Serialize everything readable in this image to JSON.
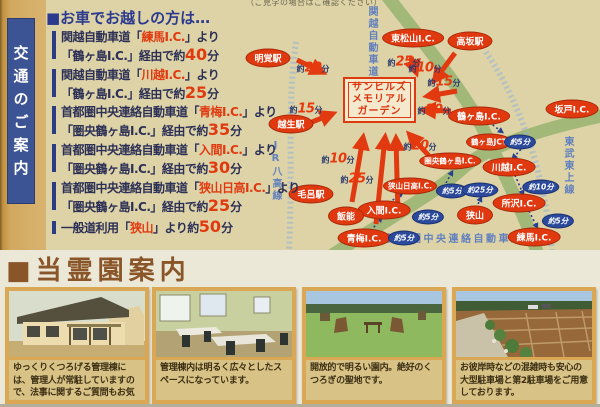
{
  "note": {
    "text": "（ご見学の場合はご確認ください）"
  },
  "sidebar": {
    "label": "交通のご案内"
  },
  "directions": {
    "title": "■お車でお越しの方は…",
    "entries": [
      {
        "pre1": "関越自動車道「",
        "ic": "練馬I.C.",
        "post1": "」より",
        "pre2": "「鶴ヶ島I.C.」経由で約",
        "min": "40",
        "suf": "分"
      },
      {
        "pre1": "関越自動車道「",
        "ic": "川越I.C.",
        "post1": "」より",
        "pre2": "「鶴ヶ島I.C.」経由で約",
        "min": "25",
        "suf": "分"
      },
      {
        "pre1": "首都圏中央連絡自動車道「",
        "ic": "青梅I.C.",
        "post1": "」より",
        "pre2": "「圏央鶴ヶ島I.C.」経由で約",
        "min": "35",
        "suf": "分"
      },
      {
        "pre1": "首都圏中央連絡自動車道「",
        "ic": "入間I.C.",
        "post1": "」より",
        "pre2": "「圏央鶴ヶ島I.C.」経由で約",
        "min": "30",
        "suf": "分"
      },
      {
        "pre1": "首都圏中央連絡自動車道「",
        "ic": "狭山日高I.C.",
        "post1": "」より",
        "pre2": "「圏央鶴ヶ島I.C.」経由で約",
        "min": "25",
        "suf": "分"
      },
      {
        "pre1": "一般道利用「",
        "ic": "狭山",
        "post1": "」より約",
        "min": "50",
        "suf": "分"
      }
    ]
  },
  "map": {
    "facility": {
      "line1": "サンヒルズ",
      "line2": "メモリアル",
      "line3": "ガーデン"
    },
    "road_labels": {
      "kanetsu": "関越自動車道",
      "jr_hachiko": "JR八高線",
      "tobu_tojo": "東武東上線",
      "keno": "首都圏中央連絡自動車道"
    },
    "time_prefix": "約",
    "time_suffix": "分",
    "nodes": [
      {
        "label": "明覚駅",
        "x": 268,
        "y": 58,
        "type": "red"
      },
      {
        "label": "東松山I.C.",
        "x": 413,
        "y": 38,
        "type": "red"
      },
      {
        "label": "高坂駅",
        "x": 470,
        "y": 41,
        "type": "red"
      },
      {
        "label": "越生駅",
        "x": 291,
        "y": 124,
        "type": "red"
      },
      {
        "label": "坂戸I.C.",
        "x": 572,
        "y": 109,
        "type": "red"
      },
      {
        "label": "鶴ヶ島I.C.",
        "x": 479,
        "y": 116,
        "type": "red"
      },
      {
        "label": "鶴ヶ島JCT",
        "x": 489,
        "y": 142,
        "type": "red",
        "small": true
      },
      {
        "label": "圏央鶴ヶ島I.C.",
        "x": 450,
        "y": 161,
        "type": "red",
        "small": true
      },
      {
        "label": "川越I.C.",
        "x": 509,
        "y": 167,
        "type": "red"
      },
      {
        "label": "狭山日高I.C.",
        "x": 410,
        "y": 186,
        "type": "red",
        "small": true
      },
      {
        "label": "毛呂駅",
        "x": 311,
        "y": 194,
        "type": "red"
      },
      {
        "label": "所沢I.C.",
        "x": 519,
        "y": 203,
        "type": "red"
      },
      {
        "label": "入間I.C.",
        "x": 384,
        "y": 210,
        "type": "red"
      },
      {
        "label": "飯能",
        "x": 346,
        "y": 216,
        "type": "red"
      },
      {
        "label": "狭山",
        "x": 475,
        "y": 215,
        "type": "red"
      },
      {
        "label": "青梅I.C.",
        "x": 364,
        "y": 238,
        "type": "red"
      },
      {
        "label": "練馬I.C.",
        "x": 534,
        "y": 237,
        "type": "red"
      },
      {
        "label": "約5分",
        "x": 520,
        "y": 142,
        "type": "blue"
      },
      {
        "label": "約10分",
        "x": 541,
        "y": 187,
        "type": "blue"
      },
      {
        "label": "約5分",
        "x": 452,
        "y": 191,
        "type": "blue"
      },
      {
        "label": "約25分",
        "x": 480,
        "y": 190,
        "type": "blue"
      },
      {
        "label": "約5分",
        "x": 428,
        "y": 217,
        "type": "blue"
      },
      {
        "label": "約5分",
        "x": 558,
        "y": 221,
        "type": "blue"
      },
      {
        "label": "約5分",
        "x": 404,
        "y": 238,
        "type": "blue"
      }
    ],
    "times": [
      {
        "num": "20",
        "x": 313,
        "y": 66
      },
      {
        "num": "15",
        "x": 306,
        "y": 107
      },
      {
        "num": "10",
        "x": 338,
        "y": 157
      },
      {
        "num": "25",
        "x": 357,
        "y": 177
      },
      {
        "num": "25",
        "x": 404,
        "y": 60
      },
      {
        "num": "10",
        "x": 425,
        "y": 66
      },
      {
        "num": "15",
        "x": 444,
        "y": 80
      },
      {
        "num": "20",
        "x": 434,
        "y": 108
      },
      {
        "num": "20",
        "x": 420,
        "y": 144
      }
    ]
  },
  "gallery": {
    "title": "■当霊園案内",
    "photos": [
      {
        "caption": "ゆっくりくつろげる管理棟には、管理人が常駐していますので、法事に関するご質問もお気軽に。"
      },
      {
        "caption": "管理棟内は明るく広々としたスペースになっています。"
      },
      {
        "caption": "開放的で明るい園内。絶好のくつろぎの聖地です。"
      },
      {
        "caption": "お彼岸時などの混雑時も安心の大型駐車場と第2駐車場をご用意しております。"
      }
    ]
  },
  "colors": {
    "accent_red": "#e23a10",
    "navy": "#2c3a6e",
    "map_bg": "#ddd3a6",
    "gold_strip": "#d2a85e",
    "brown_heading": "#8a5528",
    "road_green": "#a2b878",
    "blue_label": "#6381bd"
  }
}
